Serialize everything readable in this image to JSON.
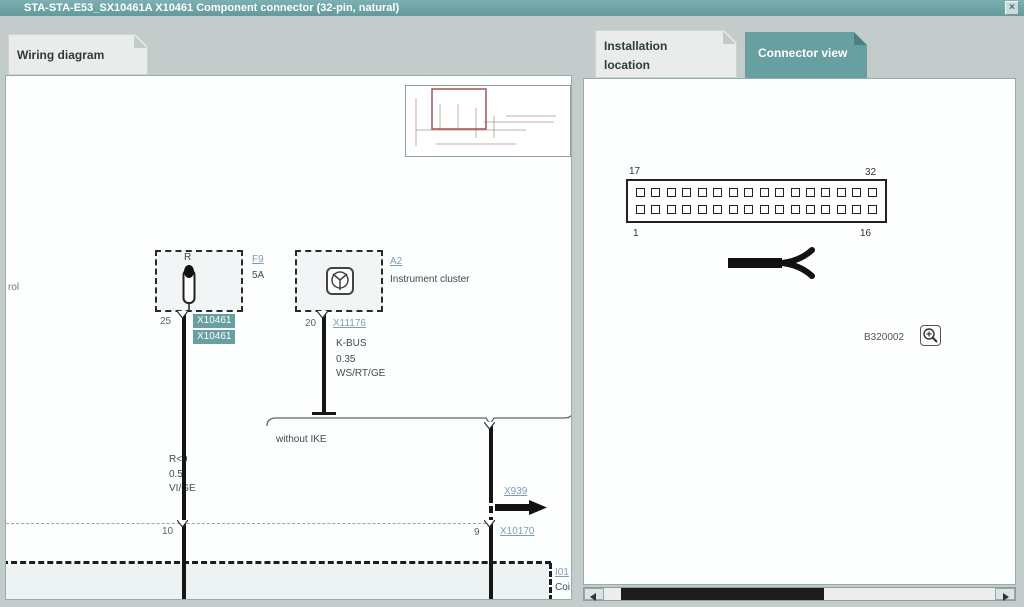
{
  "window": {
    "title": "STA-STA-E53_SX10461A X10461 Component connector (32-pin, natural)",
    "close_glyph": "×"
  },
  "tabs": {
    "wiring_diagram": "Wiring diagram",
    "installation_location": "Installation location",
    "connector_view": "Connector view"
  },
  "wiring_diagram": {
    "left_edge_label": "rol",
    "fuse": {
      "code": "R",
      "link": "F9",
      "rating": "5A",
      "pin": "25",
      "tags": [
        "X10461",
        "X10461"
      ]
    },
    "instrument_cluster": {
      "link": "A2",
      "caption": "Instrument cluster",
      "pin": "20",
      "connector_link": "X11176"
    },
    "kbus_wire": {
      "line1": "K-BUS",
      "line2": "0.35",
      "line3": "WS/RT/GE"
    },
    "left_wire": {
      "line1": "R<9",
      "line2": "0.5",
      "line3": "VI/GE"
    },
    "branch_label": "without IKE",
    "offpage_link": "X939",
    "rail": {
      "left_pin": "10",
      "right_pin": "9",
      "link": "X10170"
    },
    "bottom_component": {
      "link": "I01",
      "caption": "Coi"
    }
  },
  "connector_view": {
    "pins_per_row": 16,
    "labels": {
      "top_left": "17",
      "top_right": "32",
      "bottom_left": "1",
      "bottom_right": "16"
    },
    "figure_id": "B320002"
  },
  "colors": {
    "accent_teal": "#68a0a2",
    "link_blue": "#7d9cb5",
    "viewport_red": "#a85050"
  }
}
